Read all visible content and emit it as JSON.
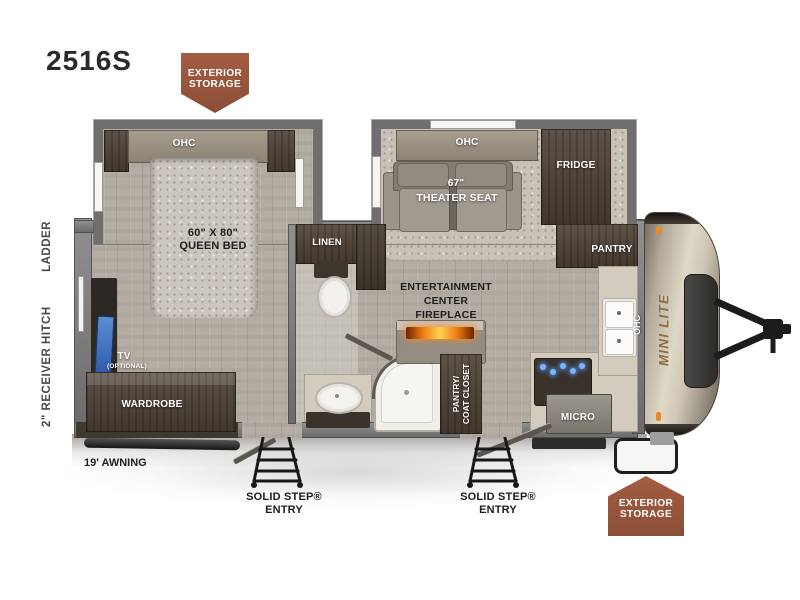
{
  "model": "2516S",
  "colors": {
    "badge_brown": "#9a5a40",
    "fireplace_glow": "#ff8c1a",
    "tv_blue": "#3f6fc0",
    "burner_blue": "#63a8ff",
    "cap_champagne": "#d9d2c2",
    "brand_bronze": "#8a6c45"
  },
  "badges": {
    "top_line1": "EXTERIOR",
    "top_line2": "STORAGE",
    "bottom_line1": "EXTERIOR",
    "bottom_line2": "STORAGE"
  },
  "exterior": {
    "receiver_hitch": "2\" RECEIVER HITCH",
    "ladder": "LADDER",
    "awning": "19' AWNING",
    "entry1_line1": "SOLID STEP®",
    "entry1_line2": "ENTRY",
    "entry2_line1": "SOLID STEP®",
    "entry2_line2": "ENTRY",
    "brand": "MINI LITE"
  },
  "bedroom": {
    "ohc": "OHC",
    "bed_size": "60\" X 80\"",
    "bed_name": "QUEEN BED",
    "tv": "TV",
    "tv_note": "(OPTIONAL)",
    "wardrobe": "WARDROBE"
  },
  "living": {
    "ohc": "OHC",
    "seat_size": "67\"",
    "seat_name": "THEATER SEAT",
    "fridge": "FRIDGE",
    "ent_line1": "ENTERTAINMENT",
    "ent_line2": "CENTER",
    "ent_line3": "FIREPLACE"
  },
  "bath": {
    "linen": "LINEN"
  },
  "kitchen": {
    "pantry": "PANTRY",
    "ohc": "OHC",
    "micro": "MICRO",
    "closet_line1": "PANTRY/",
    "closet_line2": "COAT CLOSET"
  }
}
